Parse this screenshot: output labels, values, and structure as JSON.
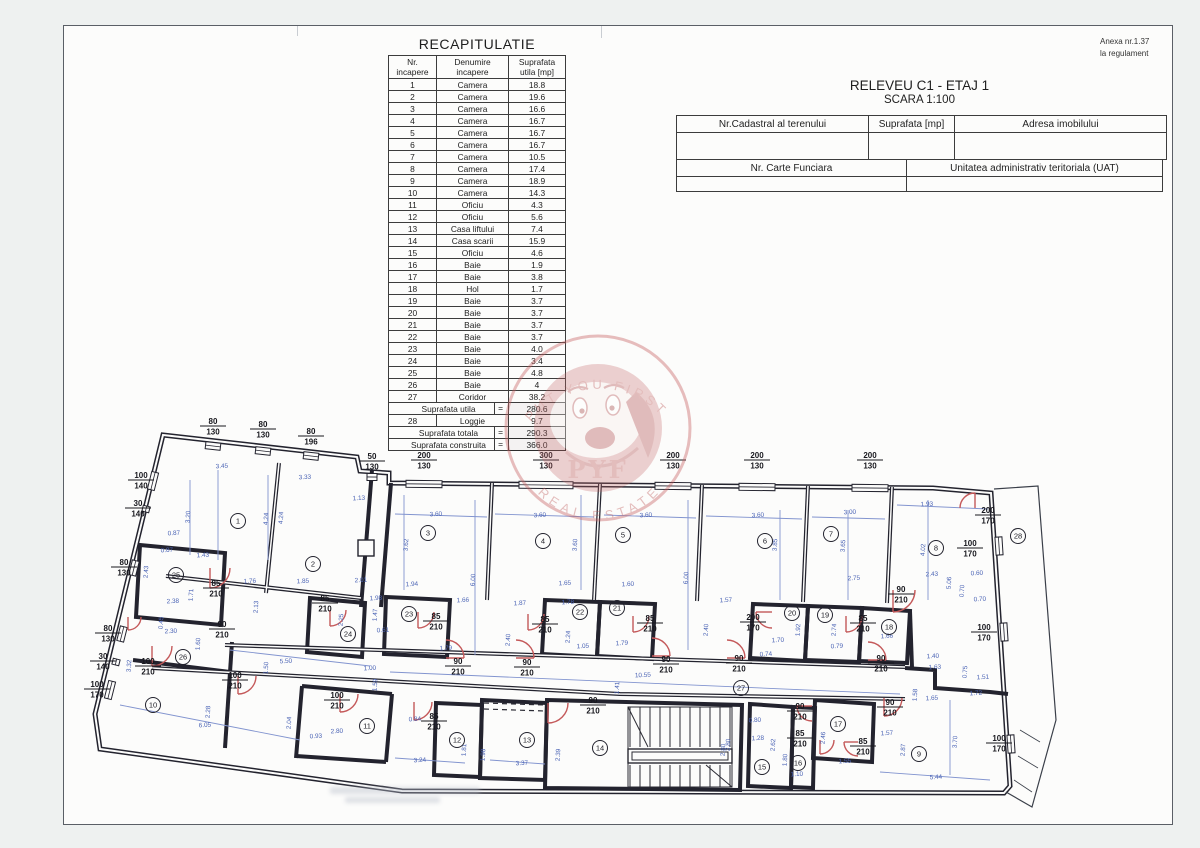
{
  "anexa": {
    "line1": "Anexa nr.1.37",
    "line2": "la regulament"
  },
  "title_block": {
    "title": "RELEVEU C1 - ETAJ 1",
    "scale": "SCARA 1:100",
    "cadastral_label": "Nr.Cadastral al terenului",
    "area_label": "Suprafata [mp]",
    "address_label": "Adresa imobilului",
    "land_book_label": "Nr. Carte Funciara",
    "uat_label": "Unitatea administrativ teritoriala (UAT)"
  },
  "recap_table": {
    "title": "RECAPITULATIE",
    "headers": {
      "col1a": "Nr.",
      "col1b": "incapere",
      "col2a": "Denumire",
      "col2b": "incapere",
      "col3a": "Suprafata",
      "col3b": "utila   [mp]"
    },
    "rows": [
      {
        "nr": "1",
        "name": "Camera",
        "area": "18.8"
      },
      {
        "nr": "2",
        "name": "Camera",
        "area": "19.6"
      },
      {
        "nr": "3",
        "name": "Camera",
        "area": "16.6"
      },
      {
        "nr": "4",
        "name": "Camera",
        "area": "16.7"
      },
      {
        "nr": "5",
        "name": "Camera",
        "area": "16.7"
      },
      {
        "nr": "6",
        "name": "Camera",
        "area": "16.7"
      },
      {
        "nr": "7",
        "name": "Camera",
        "area": "10.5"
      },
      {
        "nr": "8",
        "name": "Camera",
        "area": "17.4"
      },
      {
        "nr": "9",
        "name": "Camera",
        "area": "18.9"
      },
      {
        "nr": "10",
        "name": "Camera",
        "area": "14.3"
      },
      {
        "nr": "11",
        "name": "Oficiu",
        "area": "4.3"
      },
      {
        "nr": "12",
        "name": "Oficiu",
        "area": "5.6"
      },
      {
        "nr": "13",
        "name": "Casa liftului",
        "area": "7.4"
      },
      {
        "nr": "14",
        "name": "Casa scarii",
        "area": "15.9"
      },
      {
        "nr": "15",
        "name": "Oficiu",
        "area": "4.6"
      },
      {
        "nr": "16",
        "name": "Baie",
        "area": "1.9"
      },
      {
        "nr": "17",
        "name": "Baie",
        "area": "3.8"
      },
      {
        "nr": "18",
        "name": "Hol",
        "area": "1.7"
      },
      {
        "nr": "19",
        "name": "Baie",
        "area": "3.7"
      },
      {
        "nr": "20",
        "name": "Baie",
        "area": "3.7"
      },
      {
        "nr": "21",
        "name": "Baie",
        "area": "3.7"
      },
      {
        "nr": "22",
        "name": "Baie",
        "area": "3.7"
      },
      {
        "nr": "23",
        "name": "Baie",
        "area": "4.0"
      },
      {
        "nr": "24",
        "name": "Baie",
        "area": "3.4"
      },
      {
        "nr": "25",
        "name": "Baie",
        "area": "4.8"
      },
      {
        "nr": "26",
        "name": "Baie",
        "area": "4"
      },
      {
        "nr": "27",
        "name": "Coridor",
        "area": "38.2"
      },
      {
        "label": "Suprafata utila",
        "eq": "=",
        "area": "280.6"
      },
      {
        "nr": "28",
        "name": "Loggie",
        "area": "9.7"
      },
      {
        "label": "Suprafata totala",
        "eq": "=",
        "area": "290.3"
      },
      {
        "label": "Suprafata construita",
        "eq": "=",
        "area": "366.0"
      }
    ]
  },
  "watermark": {
    "top": "PUT YOU FIRST",
    "mid": "PYF",
    "bottom": "REAL ESTATE"
  },
  "plan": {
    "rooms": [
      [
        238,
        521,
        "1"
      ],
      [
        313,
        564,
        "2"
      ],
      [
        428,
        533,
        "3"
      ],
      [
        543,
        541,
        "4"
      ],
      [
        623,
        535,
        "5"
      ],
      [
        765,
        541,
        "6"
      ],
      [
        831,
        534,
        "7"
      ],
      [
        936,
        548,
        "8"
      ],
      [
        919,
        754,
        "9"
      ],
      [
        153,
        705,
        "10"
      ],
      [
        367,
        726,
        "11"
      ],
      [
        457,
        740,
        "12"
      ],
      [
        527,
        740,
        "13"
      ],
      [
        600,
        748,
        "14"
      ],
      [
        762,
        767,
        "15"
      ],
      [
        798,
        763,
        "16"
      ],
      [
        838,
        724,
        "17"
      ],
      [
        889,
        627,
        "18"
      ],
      [
        825,
        615,
        "19"
      ],
      [
        792,
        613,
        "20"
      ],
      [
        617,
        608,
        "21"
      ],
      [
        580,
        612,
        "22"
      ],
      [
        409,
        614,
        "23"
      ],
      [
        348,
        634,
        "24"
      ],
      [
        176,
        575,
        "25"
      ],
      [
        183,
        657,
        "26"
      ],
      [
        741,
        688,
        "27"
      ],
      [
        1018,
        536,
        "28"
      ]
    ],
    "size_labels": [
      [
        213,
        424,
        "80",
        "130"
      ],
      [
        263,
        427,
        "80",
        "130"
      ],
      [
        311,
        434,
        "80",
        "196"
      ],
      [
        372,
        459,
        "50",
        "130"
      ],
      [
        424,
        458,
        "200",
        "130"
      ],
      [
        546,
        458,
        "300",
        "130"
      ],
      [
        673,
        458,
        "200",
        "130"
      ],
      [
        757,
        458,
        "200",
        "130"
      ],
      [
        870,
        458,
        "200",
        "130"
      ],
      [
        988,
        513,
        "200",
        "170"
      ],
      [
        970,
        546,
        "100",
        "170"
      ],
      [
        984,
        630,
        "100",
        "170"
      ],
      [
        999,
        741,
        "100",
        "170"
      ],
      [
        141,
        478,
        "100",
        "140"
      ],
      [
        138,
        506,
        "30",
        "140"
      ],
      [
        124,
        565,
        "80",
        "130"
      ],
      [
        108,
        631,
        "80",
        "130"
      ],
      [
        103,
        659,
        "30",
        "140"
      ],
      [
        97,
        687,
        "100",
        "170"
      ],
      [
        216,
        586,
        "85",
        "210"
      ],
      [
        325,
        601,
        "85",
        "210"
      ],
      [
        436,
        619,
        "85",
        "210"
      ],
      [
        545,
        622,
        "85",
        "210"
      ],
      [
        650,
        621,
        "85",
        "210"
      ],
      [
        863,
        621,
        "85",
        "210"
      ],
      [
        753,
        620,
        "200",
        "170"
      ],
      [
        222,
        627,
        "90",
        "210"
      ],
      [
        458,
        664,
        "90",
        "210"
      ],
      [
        527,
        665,
        "90",
        "210"
      ],
      [
        666,
        662,
        "90",
        "210"
      ],
      [
        739,
        661,
        "90",
        "210"
      ],
      [
        881,
        661,
        "90",
        "210"
      ],
      [
        901,
        592,
        "90",
        "210"
      ],
      [
        148,
        664,
        "100",
        "210"
      ],
      [
        235,
        678,
        "100",
        "210"
      ],
      [
        337,
        698,
        "100",
        "210"
      ],
      [
        593,
        703,
        "90",
        "210"
      ],
      [
        434,
        719,
        "85",
        "210"
      ],
      [
        800,
        709,
        "90",
        "210"
      ],
      [
        800,
        736,
        "85",
        "210"
      ],
      [
        863,
        744,
        "85",
        "210"
      ],
      [
        890,
        705,
        "90",
        "210"
      ]
    ],
    "dims": [
      [
        222,
        468,
        "3.45"
      ],
      [
        305,
        479,
        "3.33"
      ],
      [
        359,
        500,
        "1.13"
      ],
      [
        190,
        517,
        "3.20",
        "v"
      ],
      [
        268,
        519,
        "4.24",
        "v"
      ],
      [
        283,
        518,
        "4.24",
        "v"
      ],
      [
        174,
        535,
        "0.87"
      ],
      [
        167,
        552,
        "0.87"
      ],
      [
        203,
        557,
        "1.43"
      ],
      [
        250,
        583,
        "1.76"
      ],
      [
        303,
        583,
        "1.85"
      ],
      [
        361,
        582,
        "2.01"
      ],
      [
        148,
        572,
        "2.43",
        "v"
      ],
      [
        193,
        595,
        "1.71",
        "v"
      ],
      [
        173,
        603,
        "2.38"
      ],
      [
        258,
        607,
        "2.13",
        "v"
      ],
      [
        376,
        600,
        "1.98"
      ],
      [
        383,
        632,
        "0.61"
      ],
      [
        343,
        620,
        "2.25",
        "v"
      ],
      [
        377,
        615,
        "1.47",
        "v"
      ],
      [
        163,
        623,
        "0.45",
        "v"
      ],
      [
        171,
        633,
        "2.30"
      ],
      [
        436,
        516,
        "3.60"
      ],
      [
        540,
        517,
        "3.60"
      ],
      [
        646,
        517,
        "3.60"
      ],
      [
        758,
        517,
        "3.60"
      ],
      [
        850,
        514,
        "3.00"
      ],
      [
        927,
        506,
        "1.93"
      ],
      [
        408,
        545,
        "3.62",
        "v"
      ],
      [
        577,
        545,
        "3.60",
        "v"
      ],
      [
        777,
        545,
        "3.85",
        "v"
      ],
      [
        845,
        546,
        "3.65",
        "v"
      ],
      [
        925,
        550,
        "4.02",
        "v"
      ],
      [
        475,
        580,
        "6.00",
        "v"
      ],
      [
        688,
        578,
        "6.00",
        "v"
      ],
      [
        412,
        586,
        "1.94"
      ],
      [
        565,
        585,
        "1.65"
      ],
      [
        628,
        586,
        "1.60"
      ],
      [
        726,
        602,
        "1.57"
      ],
      [
        463,
        602,
        "1.66"
      ],
      [
        520,
        605,
        "1.87"
      ],
      [
        568,
        604,
        "1.78"
      ],
      [
        854,
        580,
        "2.75"
      ],
      [
        510,
        640,
        "2.40",
        "v"
      ],
      [
        570,
        637,
        "2.24",
        "v"
      ],
      [
        800,
        630,
        "1.92",
        "v"
      ],
      [
        836,
        630,
        "2.74",
        "v"
      ],
      [
        708,
        630,
        "2.40",
        "v"
      ],
      [
        446,
        650,
        "1.79"
      ],
      [
        583,
        648,
        "1.05"
      ],
      [
        622,
        645,
        "1.79"
      ],
      [
        778,
        642,
        "1.70"
      ],
      [
        766,
        656,
        "0.74"
      ],
      [
        837,
        648,
        "0.79"
      ],
      [
        887,
        638,
        "1.66"
      ],
      [
        932,
        576,
        "2.43"
      ],
      [
        977,
        575,
        "0.60"
      ],
      [
        951,
        583,
        "5.06",
        "v"
      ],
      [
        964,
        591,
        "0.70",
        "v"
      ],
      [
        980,
        601,
        "0.70"
      ],
      [
        933,
        658,
        "1.40"
      ],
      [
        935,
        669,
        "1.63"
      ],
      [
        983,
        679,
        "1.51"
      ],
      [
        967,
        672,
        "0.75",
        "v"
      ],
      [
        917,
        695,
        "1.58",
        "v"
      ],
      [
        976,
        695,
        "1.72"
      ],
      [
        286,
        663,
        "5.50"
      ],
      [
        370,
        670,
        "1.00"
      ],
      [
        268,
        668,
        "1.50",
        "v"
      ],
      [
        377,
        685,
        "1.59",
        "v"
      ],
      [
        210,
        712,
        "2.28",
        "v"
      ],
      [
        205,
        727,
        "6.05"
      ],
      [
        291,
        723,
        "2.04",
        "v"
      ],
      [
        316,
        738,
        "0.93"
      ],
      [
        337,
        733,
        "2.80"
      ],
      [
        131,
        666,
        "3.32",
        "v"
      ],
      [
        200,
        644,
        "1.60",
        "v"
      ],
      [
        643,
        677,
        "10.55"
      ],
      [
        420,
        762,
        "3.24"
      ],
      [
        522,
        765,
        "3.37"
      ],
      [
        485,
        755,
        "1.98",
        "v"
      ],
      [
        466,
        750,
        "1.81",
        "v"
      ],
      [
        560,
        755,
        "2.39",
        "v"
      ],
      [
        725,
        750,
        "2.80",
        "v"
      ],
      [
        619,
        688,
        "1.41",
        "v"
      ],
      [
        415,
        721,
        "0.84"
      ],
      [
        755,
        722,
        "0.80"
      ],
      [
        758,
        740,
        "1.28"
      ],
      [
        775,
        745,
        "2.62",
        "v"
      ],
      [
        730,
        745,
        "2.80",
        "v"
      ],
      [
        787,
        760,
        "1.80",
        "v"
      ],
      [
        797,
        776,
        "1.10"
      ],
      [
        845,
        763,
        "1.55"
      ],
      [
        825,
        738,
        "2.46",
        "v"
      ],
      [
        887,
        735,
        "1.57"
      ],
      [
        905,
        750,
        "2.87",
        "v"
      ],
      [
        957,
        742,
        "3.70",
        "v"
      ],
      [
        936,
        779,
        "5.44"
      ],
      [
        932,
        700,
        "1.65"
      ]
    ]
  }
}
